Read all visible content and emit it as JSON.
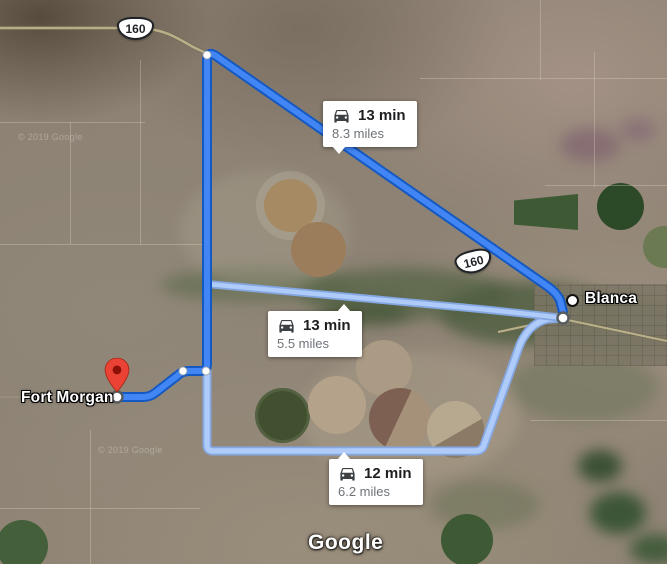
{
  "map": {
    "attribution_logo": "Google",
    "imagery_watermark": "© 2019 Google",
    "markers": [
      {
        "label": "Fort Morgan",
        "type": "destination-pin"
      },
      {
        "label": "Blanca",
        "type": "town-dot"
      }
    ],
    "shields": [
      {
        "route": "160"
      },
      {
        "route": "160"
      }
    ],
    "route_labels": [
      {
        "mode": "car",
        "duration": "13 min",
        "distance": "8.3 miles"
      },
      {
        "mode": "car",
        "duration": "13 min",
        "distance": "5.5 miles"
      },
      {
        "mode": "car",
        "duration": "12 min",
        "distance": "6.2 miles"
      }
    ],
    "colors": {
      "route_primary": "#4285f4",
      "route_primary_border": "#1458c2",
      "route_alternate": "#aecbfa",
      "route_alternate_border": "#84a7e2",
      "pin_red": "#ea4335",
      "road_yellow": "#b9b08a"
    }
  }
}
